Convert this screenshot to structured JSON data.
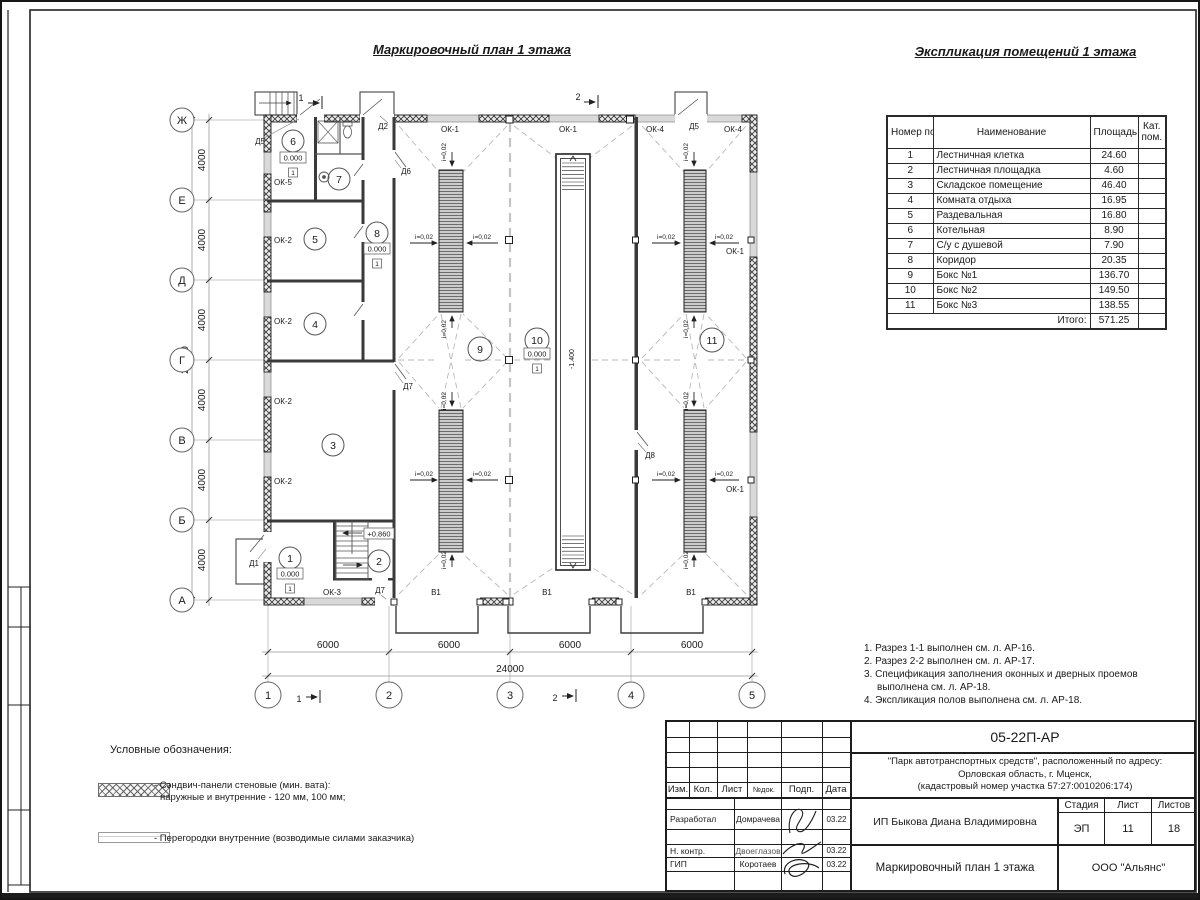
{
  "plan": {
    "title": "Маркировочный план 1 этажа",
    "axis_rows": [
      "Ж",
      "Е",
      "Д",
      "Г",
      "В",
      "Б",
      "А"
    ],
    "axis_cols": [
      "1",
      "2",
      "3",
      "4",
      "5"
    ],
    "dims": {
      "bay_v": "4000",
      "total_v": "24000",
      "bay_h": "6000",
      "total_h": "24000"
    },
    "labels": {
      "ok1": "ОК-1",
      "ok2": "ОК-2",
      "ok3": "ОК-3",
      "ok4": "ОК-4",
      "ok5": "ОК-5",
      "d1": "Д1",
      "d2": "Д2",
      "d5": "Д5",
      "d6": "Д6",
      "d7": "Д7",
      "d8": "Д8",
      "v1": "В1",
      "slope": "i=0,02",
      "lvl0": "0.000",
      "lvl_up": "+0.860",
      "lvl_pit": "-1.400",
      "floor": "1"
    },
    "rooms": [
      "1",
      "2",
      "3",
      "4",
      "5",
      "6",
      "7",
      "8",
      "9",
      "10",
      "11"
    ],
    "sections": {
      "s1": "1",
      "s2": "2"
    }
  },
  "table": {
    "title": "Экспликация помещений 1 этажа",
    "headers": {
      "num": "Номер помещ.",
      "name": "Наименование",
      "area": "Площадь",
      "cat": "Кат. пом."
    },
    "rows": [
      {
        "n": "1",
        "name": "Лестничная клетка",
        "area": "24.60"
      },
      {
        "n": "2",
        "name": "Лестничная площадка",
        "area": "4.60"
      },
      {
        "n": "3",
        "name": "Складское помещение",
        "area": "46.40"
      },
      {
        "n": "4",
        "name": "Комната отдыха",
        "area": "16.95"
      },
      {
        "n": "5",
        "name": "Раздевальная",
        "area": "16.80"
      },
      {
        "n": "6",
        "name": "Котельная",
        "area": "8.90"
      },
      {
        "n": "7",
        "name": "С/у с душевой",
        "area": "7.90"
      },
      {
        "n": "8",
        "name": "Коридор",
        "area": "20.35"
      },
      {
        "n": "9",
        "name": "Бокс №1",
        "area": "136.70"
      },
      {
        "n": "10",
        "name": "Бокс №2",
        "area": "149.50"
      },
      {
        "n": "11",
        "name": "Бокс №3",
        "area": "138.55"
      }
    ],
    "total_label": "Итого:",
    "total": "571.25"
  },
  "notes": {
    "n1": "1. Разрез 1-1 выполнен см. л. АР-16.",
    "n2": "2. Разрез 2-2 выполнен см. л. АР-17.",
    "n3": "3. Спецификация заполнения оконных и дверных проемов выполнена см. л. АР-18.",
    "n4": "4. Экспликация полов выполнена см. л. АР-18."
  },
  "legend": {
    "title": "Условные обозначения:",
    "item1_line1": "- Сэндвич-панели стеновые (мин. вата):",
    "item1_line2": "наружные и внутренние - 120 мм, 100 мм;",
    "item2": "- Перегородки внутренние (возводимые силами заказчика)"
  },
  "titleblock": {
    "code": "05-22П-АР",
    "project_line1": "\"Парк автотранспортных средств\",  расположенный по адресу:",
    "project_line2": "Орловская область, г. Мценск,",
    "project_line3": "(кадастровый номер участка 57:27:0010206:174)",
    "client": "ИП Быкова Диана Владимировна",
    "cols": {
      "izm": "Изм.",
      "kol": "Кол.",
      "list": "Лист",
      "ndok": "№док.",
      "podp": "Подп.",
      "data": "Дата"
    },
    "stage_label": "Стадия",
    "sheet_label": "Лист",
    "sheets_label": "Листов",
    "stage": "ЭП",
    "sheet_no": "11",
    "sheets_total": "18",
    "rows": {
      "razrab_role": "Разработал",
      "razrab_name": "Домрачева",
      "razrab_date": "03.22",
      "nkontr_role": "Н. контр.",
      "nkontr_name": "Двоеглазов",
      "nkontr_date": "03.22",
      "gip_role": "ГИП",
      "gip_name": "Коротаев",
      "gip_date": "03.22"
    },
    "drawing_title": "Маркировочный план 1 этажа",
    "org": "ООО \"Альянс\""
  }
}
